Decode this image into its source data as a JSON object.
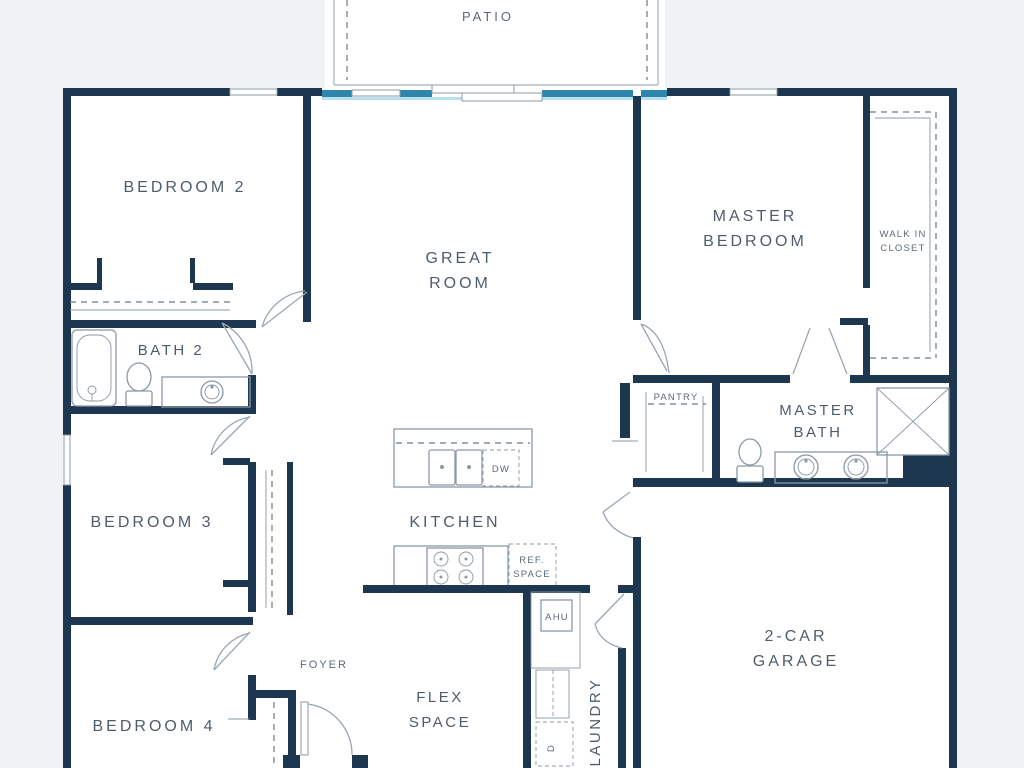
{
  "colors": {
    "wall": "#1c374f",
    "glass": "#2e86ad",
    "glass_glow": "#b7e0ef",
    "background": "#f0f2f4",
    "floor": "#ffffff",
    "fixture": "#8b99a6",
    "dash": "#6b7a87",
    "label": "#4e5d6c",
    "label_small": "#5b6b79"
  },
  "labels": {
    "patio": "PATIO",
    "bedroom2": "BEDROOM 2",
    "great_room": {
      "line1": "GREAT",
      "line2": "ROOM"
    },
    "master_bedroom": {
      "line1": "MASTER",
      "line2": "BEDROOM"
    },
    "walk_in_closet": {
      "line1": "WALK IN",
      "line2": "CLOSET"
    },
    "bath2": "BATH 2",
    "pantry": "PANTRY",
    "master_bath": {
      "line1": "MASTER",
      "line2": "BATH"
    },
    "bedroom3": "BEDROOM 3",
    "kitchen": "KITCHEN",
    "dw": "DW",
    "ref_space": {
      "line1": "REF.",
      "line2": "SPACE"
    },
    "ahu": "AHU",
    "bedroom4": "BEDROOM 4",
    "foyer": "FOYER",
    "flex_space": {
      "line1": "FLEX",
      "line2": "SPACE"
    },
    "laundry": "LAUNDRY",
    "dryer": "D",
    "garage": {
      "line1": "2-CAR",
      "line2": "GARAGE"
    }
  }
}
